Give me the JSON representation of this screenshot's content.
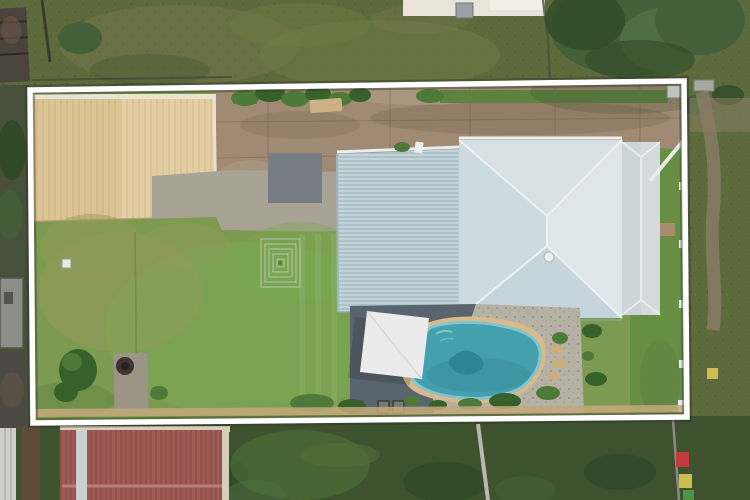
{
  "scene": {
    "type": "aerial-drone-photograph",
    "subject": "residential-property-with-pool-and-boundary-overlay",
    "overlay_shape": "property-boundary-rectangle"
  },
  "colors": {
    "outside_grass": "#5d6b3c",
    "outside_grass_patch": "#707c46",
    "outside_grass_worn": "#7e7c52",
    "outside_grass_dark": "#3f5230",
    "outside_grass_bright": "#4e7437",
    "tree_foliage": "#44603a",
    "tree_foliage_light": "#567547",
    "tree_foliage_dark": "#304a28",
    "dirt_path": "#8b7d66",
    "neighbor_shed_dark": "#4b443c",
    "neighbor_shed_rust": "#6b564a",
    "neighbor_building_cream": "#e8e4d8",
    "neighbor_box_grey": "#9aa0a3",
    "neighbor_grey_roof": "#8d8d88",
    "red_roof": "#9e5a55",
    "red_roof_ridge": "#b5807b",
    "red_roof_stripe": "#ccd1d0",
    "red_roof_trim": "#d7cdbb",
    "grey_roof_left": "#cfcfcb",
    "brown_roof_strip": "#5f4a3a",
    "boundary_white": "#ffffff",
    "boundary_shadow": "#2c2c2a",
    "lawn_base": "#7d9b50",
    "lawn_bright": "#79a751",
    "lawn_patchy": "#949a59",
    "lawn_dark_edge": "#5d7f3f",
    "right_strip_grass": "#678f44",
    "top_green_strip": "#5f823f",
    "shed_roof_tan": "#dcc494",
    "shed_roof_light": "#e6d4a9",
    "shed_gutter": "#e9e3d2",
    "driveway_concrete": "#a08a73",
    "driveway_dark": "#84705d",
    "driveway_light": "#b3a28b",
    "grey_slab": "#767d84",
    "old_concrete": "#a9a396",
    "house_roof_west": "#cddbe1",
    "house_roof_north": "#d7e1e5",
    "house_roof_east": "#dde6e9",
    "house_roof_south": "#c6d5dc",
    "patio_roof": "#c2d3da",
    "wing_roof": "#ccd6da",
    "roof_ridge_line": "#eef2f3",
    "roof_eave_shadow": "#8fa3ad",
    "paving_dark": "#59646f",
    "sail_white": "#ebebec",
    "pool_coping": "#d9ba8a",
    "pool_water": "#45a0ae",
    "pool_water_deep": "#2d8292",
    "pool_water_light": "#84c4cd",
    "gravel": "#b6b1a5",
    "stepping_stone": "#c9ad7d",
    "plant_green": "#4d7a38",
    "plant_green_dark": "#36612b",
    "fence_white": "#e9ece9",
    "landing_brown": "#a98e6e",
    "firepit_pad": "#9b9588",
    "firepit_dark": "#3a3531",
    "clothesline_line": "#b9c4b0",
    "box_red": "#c03a3e",
    "box_yellow": "#cdbd4e",
    "box_green": "#4c9440",
    "pole_grey": "#b9b9b2",
    "equip_dark": "#777d72",
    "timber_rail": "#c3a97a"
  }
}
